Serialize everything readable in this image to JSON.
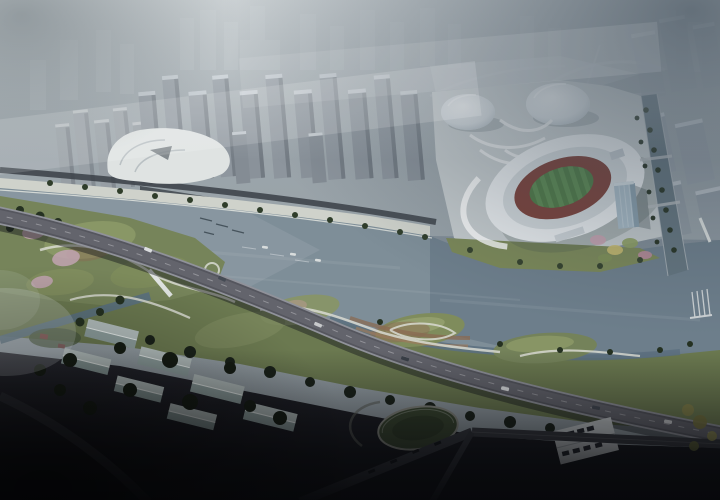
{
  "meta": {
    "type": "aerial-architectural-rendering",
    "description": "Misty aerial rendering of a riverfront masterplan: white oval stadium with red running track and green pitch, two white domed sports halls, grey residential tower clusters fading into fog, a wide grey-blue river with small boats, rolling green parks with winding light paths and pink blossom beds, a curved elevated expressway crossing the site, tree-lined canal, and dark gabled warehouses, oval lawn and canopied parking in the shadowy foreground."
  },
  "colors": {
    "fog": "#9aa4aa",
    "fog_dark": "#3c4a57",
    "haze_city": "#aeb6bb",
    "tower_face": "#8b939b",
    "tower_side": "#737b83",
    "tower_top": "#c2c9cf",
    "water": "#7e8e98",
    "water_deep": "#5b7180",
    "canal": "#64757f",
    "park_green": "#6b7950",
    "park_light": "#76845a",
    "mound_light": "#8d9a68",
    "tree_dark": "#253121",
    "path": "#d9dbd2",
    "plaza": "#c6ccce",
    "promenade": "#cfd2cb",
    "stadium_roof": "#ebeef0",
    "stadium_ring": "#d3d9dc",
    "track": "#7c4038",
    "field": "#4e7a44",
    "field_stripe": "#5b8a50",
    "dome": "#dce1e5",
    "glass_tower": "#a9bcc8",
    "viaduct": "#55565e",
    "viaduct_edge": "#8f9197",
    "road_dark": "#3a3c42",
    "warehouse_roof": "#b5c0bf",
    "blossom": "#c2a4b2",
    "terrace": "#8a6a52",
    "foreground": "#17181d",
    "lawn_dark": "#39462f",
    "boat": "#d8dcdc",
    "autumn_tree": "#85824a"
  },
  "scene": {
    "elements": [
      {
        "name": "distant-city",
        "label": "hazy city skyline in fog"
      },
      {
        "name": "residential-towers",
        "label": "cluster of grey residential high-rises"
      },
      {
        "name": "cultural-plaza",
        "label": "white curved waterfront pavilion"
      },
      {
        "name": "gym-domes",
        "label": "two white domed sports halls"
      },
      {
        "name": "stadium",
        "label": "oval stadium with red track and green pitch"
      },
      {
        "name": "stadium-tower",
        "label": "glass tower beside stadium"
      },
      {
        "name": "river",
        "label": "wide grey-blue river"
      },
      {
        "name": "canal",
        "label": "tree-lined canal"
      },
      {
        "name": "riverside-park",
        "label": "rolling green park with winding paths"
      },
      {
        "name": "blossom-garden",
        "label": "pink blossom planting beds"
      },
      {
        "name": "elevated-highway",
        "label": "curved elevated expressway with cars"
      },
      {
        "name": "pedestrian-bridge",
        "label": "white footbridge"
      },
      {
        "name": "warehouses",
        "label": "rows of gabled warehouse roofs"
      },
      {
        "name": "oval-lawn",
        "label": "oval lawn with ring path"
      },
      {
        "name": "parking-lot",
        "label": "canopied parking with cars"
      },
      {
        "name": "boats",
        "label": "small boats and moorings on the water"
      },
      {
        "name": "pier",
        "label": "finger pier on right bank"
      }
    ]
  }
}
